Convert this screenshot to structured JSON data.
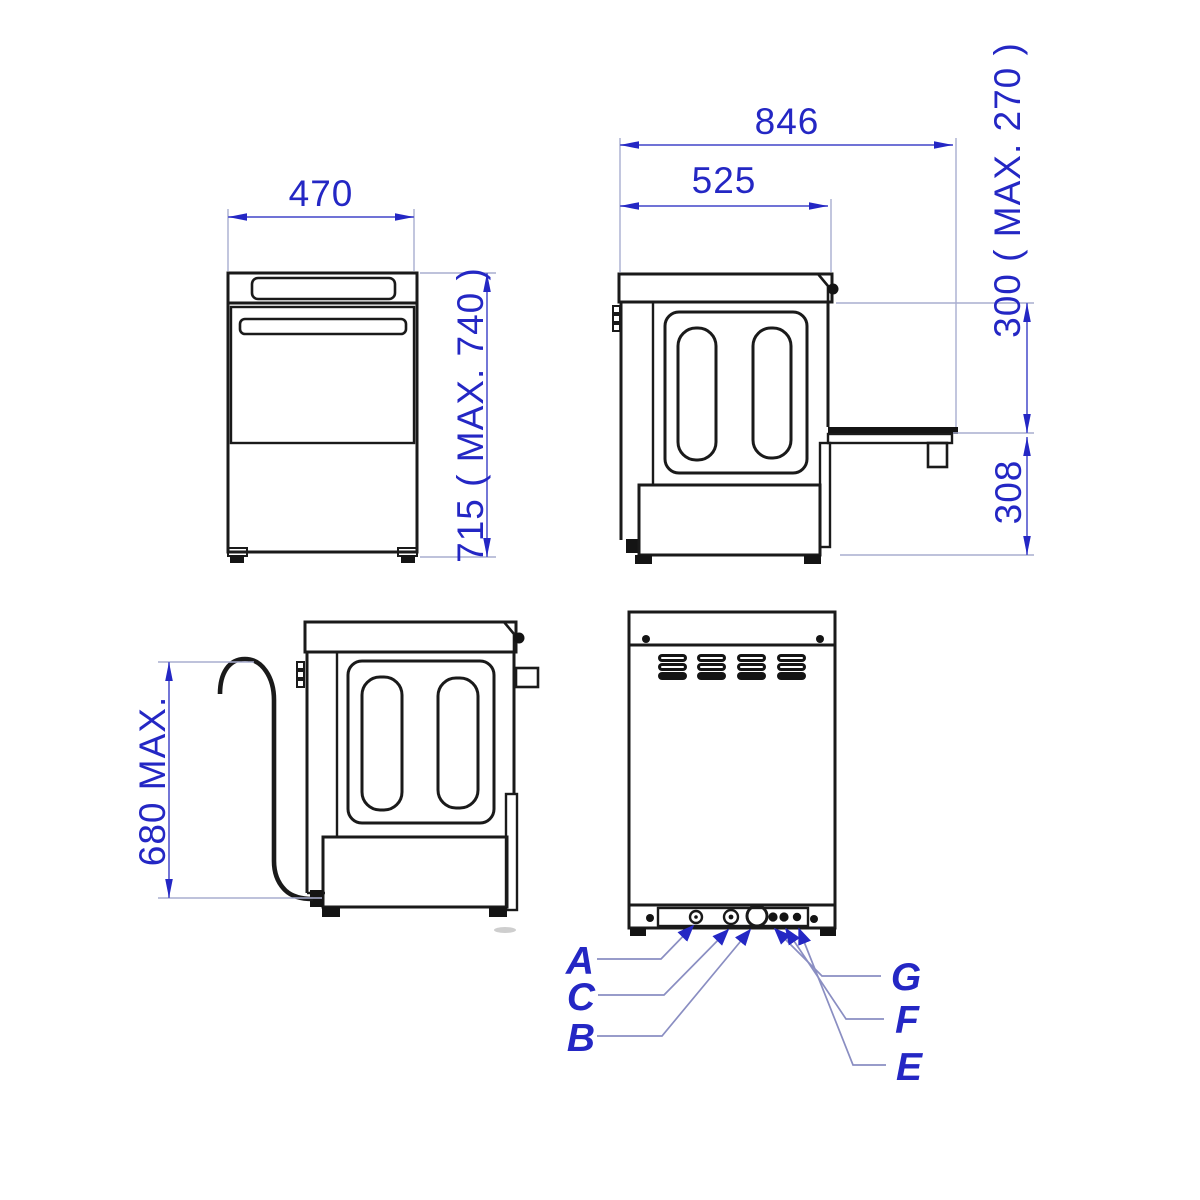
{
  "drawing_title": "appliance-dimension-drawing",
  "colors": {
    "line": "#1a1a1a",
    "dimension_text": "#2427c4",
    "dimension_line": "#5b5fd0",
    "extension_line": "#a8adcf",
    "leader_line": "#8a8ec2",
    "background": "#ffffff"
  },
  "front_view": {
    "width": "470",
    "height": "715 ( MAX. 740 )"
  },
  "side_view_open_door": {
    "depth_total": "846",
    "depth_body": "525",
    "door_level": "300 ( MAX. 270 )",
    "under_door": "308"
  },
  "side_view_drain_hose": {
    "hose_height": "680 MAX."
  },
  "rear_view": {
    "labels": {
      "a": "A",
      "b": "B",
      "c": "C",
      "e": "E",
      "f": "F",
      "g": "G"
    }
  }
}
